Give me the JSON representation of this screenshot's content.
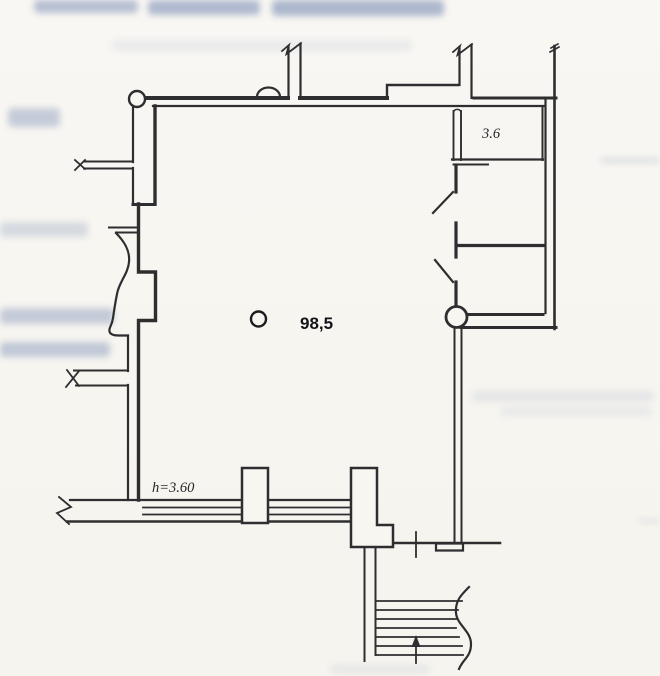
{
  "plan": {
    "small_room_area_label": "3.6",
    "main_area_label": "98,5",
    "height_label": "h=3.60"
  },
  "colors": {
    "ink": "#2e2e30",
    "paper": "#f8f6f1",
    "bleedthrough": "#7e91b6"
  }
}
